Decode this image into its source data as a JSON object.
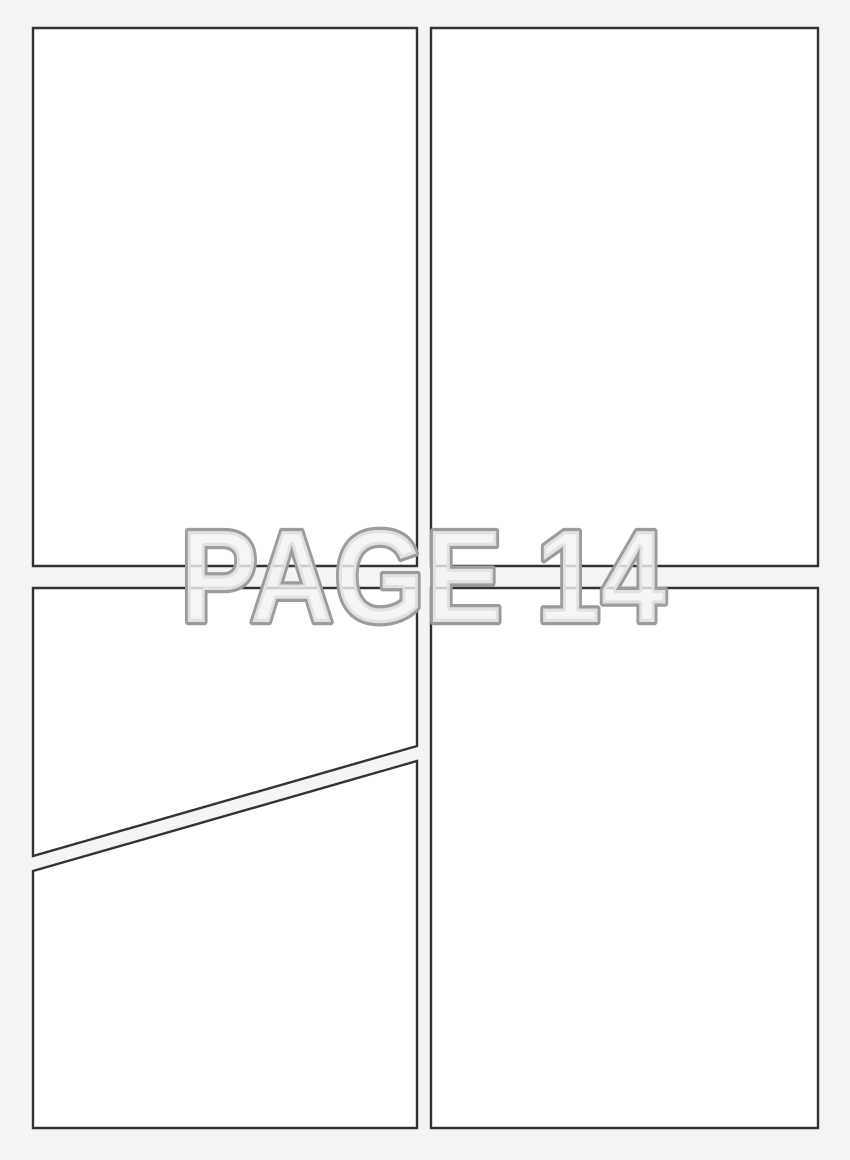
{
  "page": {
    "watermark": {
      "text": "PAGE 14"
    },
    "panel_count": 5
  },
  "colors": {
    "background": "#f4f4f4",
    "panel_fill": "#ffffff",
    "panel_border": "#333333",
    "watermark_fill": "#f3f3f3",
    "watermark_outline": "#9c9c9c"
  }
}
